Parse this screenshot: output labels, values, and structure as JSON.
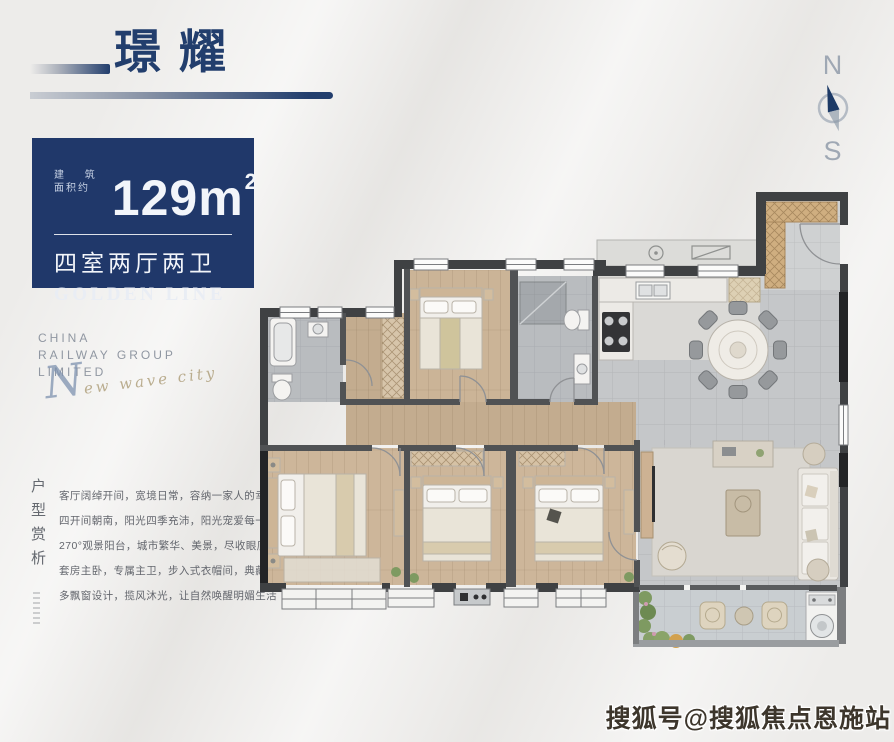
{
  "page": {
    "background": "#edecea",
    "accent_blue": "#20386a"
  },
  "header": {
    "title": "璟耀"
  },
  "compass": {
    "north_label": "N",
    "south_label": "S"
  },
  "info_card": {
    "area_label_line1": "建 筑",
    "area_label_line2": "面积约",
    "area_value": "129m",
    "area_sup": "2",
    "layout_text": "四室两厅两卫",
    "series_text": "GOLDEN LINE"
  },
  "brand": {
    "line1": "CHINA",
    "line2": "RAILWAY GROUP",
    "line3": "LIMITED",
    "script_cap": "N",
    "script_rest": "ew wave city"
  },
  "analysis": {
    "vertical_title": "户型赏析",
    "lines": [
      "客厅阔绰开间，宽境日常，容纳一家人的幸福",
      "四开间朝南，阳光四季充沛，阳光宠爱每一天",
      "270°观景阳台，城市繁华、美景，尽收眼底",
      "套房主卧，专属主卫，步入式衣帽间，典藏品位",
      "多飘窗设计，揽风沐光，让自然唤醒明媚生活"
    ]
  },
  "floorplan": {
    "colors": {
      "wall": "#3f4143",
      "wall_dark": "#232426",
      "wood_floor": "#c9b295",
      "tile_floor": "#c5c7c9",
      "bath_floor": "#b9bcbf",
      "balcony_floor": "#c9ced1",
      "plant_green": "#7d9a60"
    }
  },
  "watermark": {
    "text": "搜狐号@搜狐焦点恩施站"
  }
}
